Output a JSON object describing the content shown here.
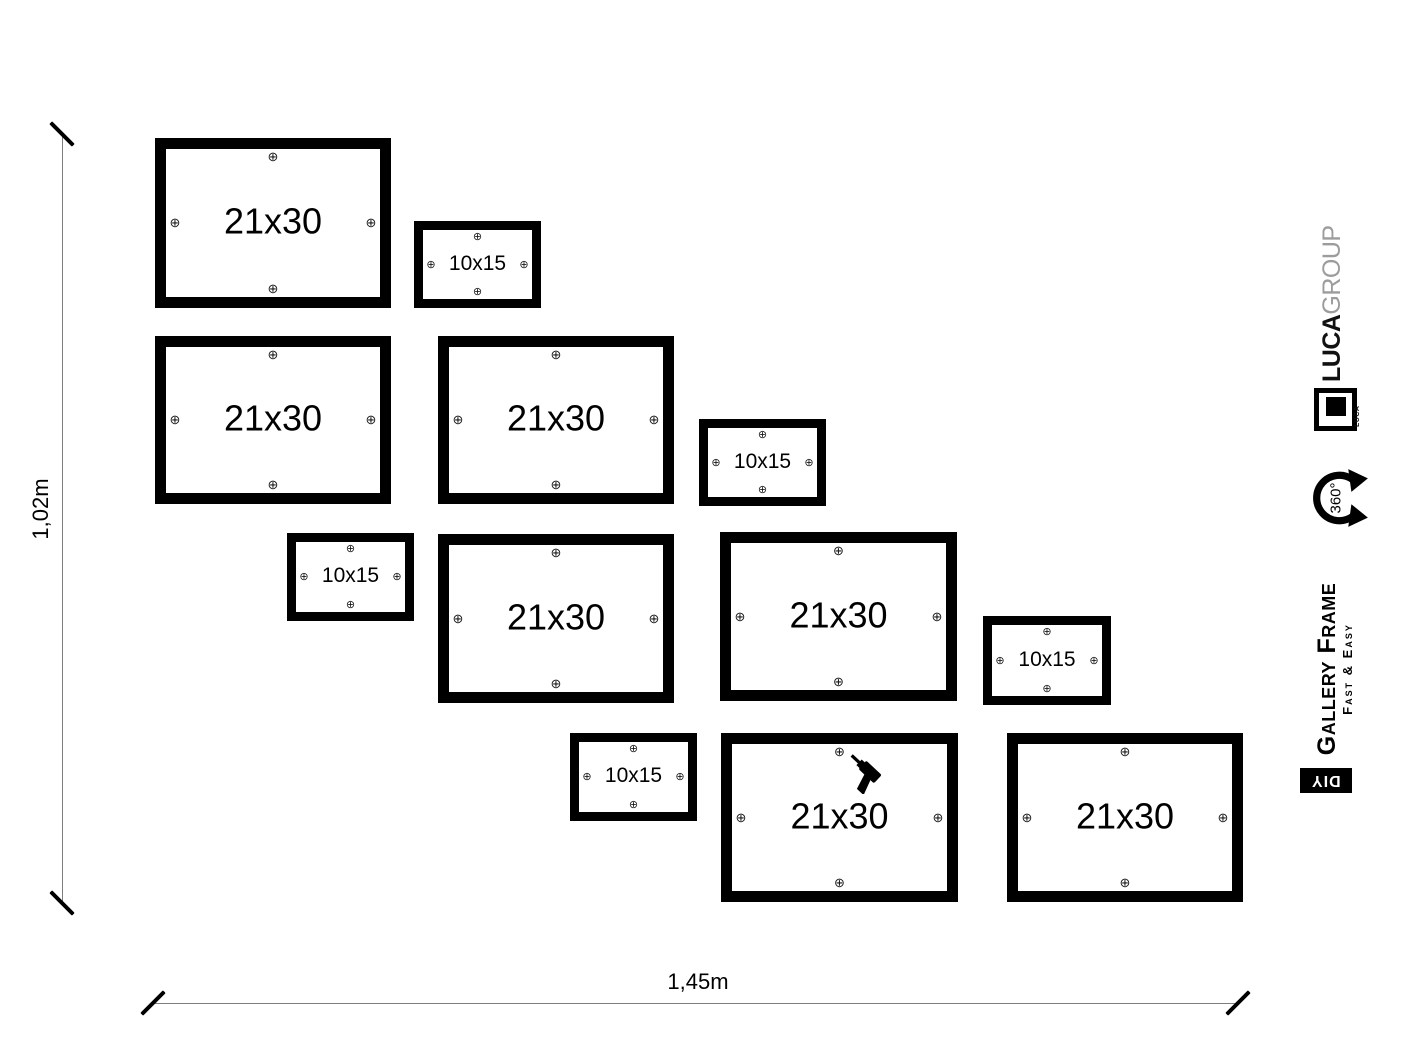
{
  "dimensions": {
    "height_label": "1,02m",
    "width_label": "1,45m"
  },
  "mount_mark_glyph": "⊕",
  "frames": [
    {
      "size": "21x30",
      "x": 155,
      "y": 138,
      "w": 236,
      "h": 170
    },
    {
      "size": "10x15",
      "x": 414,
      "y": 221,
      "w": 127,
      "h": 87
    },
    {
      "size": "21x30",
      "x": 155,
      "y": 336,
      "w": 236,
      "h": 168
    },
    {
      "size": "21x30",
      "x": 438,
      "y": 336,
      "w": 236,
      "h": 168
    },
    {
      "size": "10x15",
      "x": 699,
      "y": 419,
      "w": 127,
      "h": 87
    },
    {
      "size": "10x15",
      "x": 287,
      "y": 533,
      "w": 127,
      "h": 88
    },
    {
      "size": "21x30",
      "x": 438,
      "y": 534,
      "w": 236,
      "h": 169
    },
    {
      "size": "21x30",
      "x": 720,
      "y": 532,
      "w": 237,
      "h": 169
    },
    {
      "size": "10x15",
      "x": 983,
      "y": 616,
      "w": 128,
      "h": 89
    },
    {
      "size": "10x15",
      "x": 570,
      "y": 733,
      "w": 127,
      "h": 88
    },
    {
      "size": "21x30",
      "x": 721,
      "y": 733,
      "w": 237,
      "h": 169,
      "has_drill": true
    },
    {
      "size": "21x30",
      "x": 1007,
      "y": 733,
      "w": 236,
      "h": 169
    }
  ],
  "branding": {
    "brand_bold": "LUCA",
    "brand_light": "GROUP",
    "logo_small_text": "LUCA",
    "rotation_label": "360°",
    "product_name": "Gallery Frame",
    "product_tagline": "Fast & Easy",
    "diy_label": "DIY"
  }
}
